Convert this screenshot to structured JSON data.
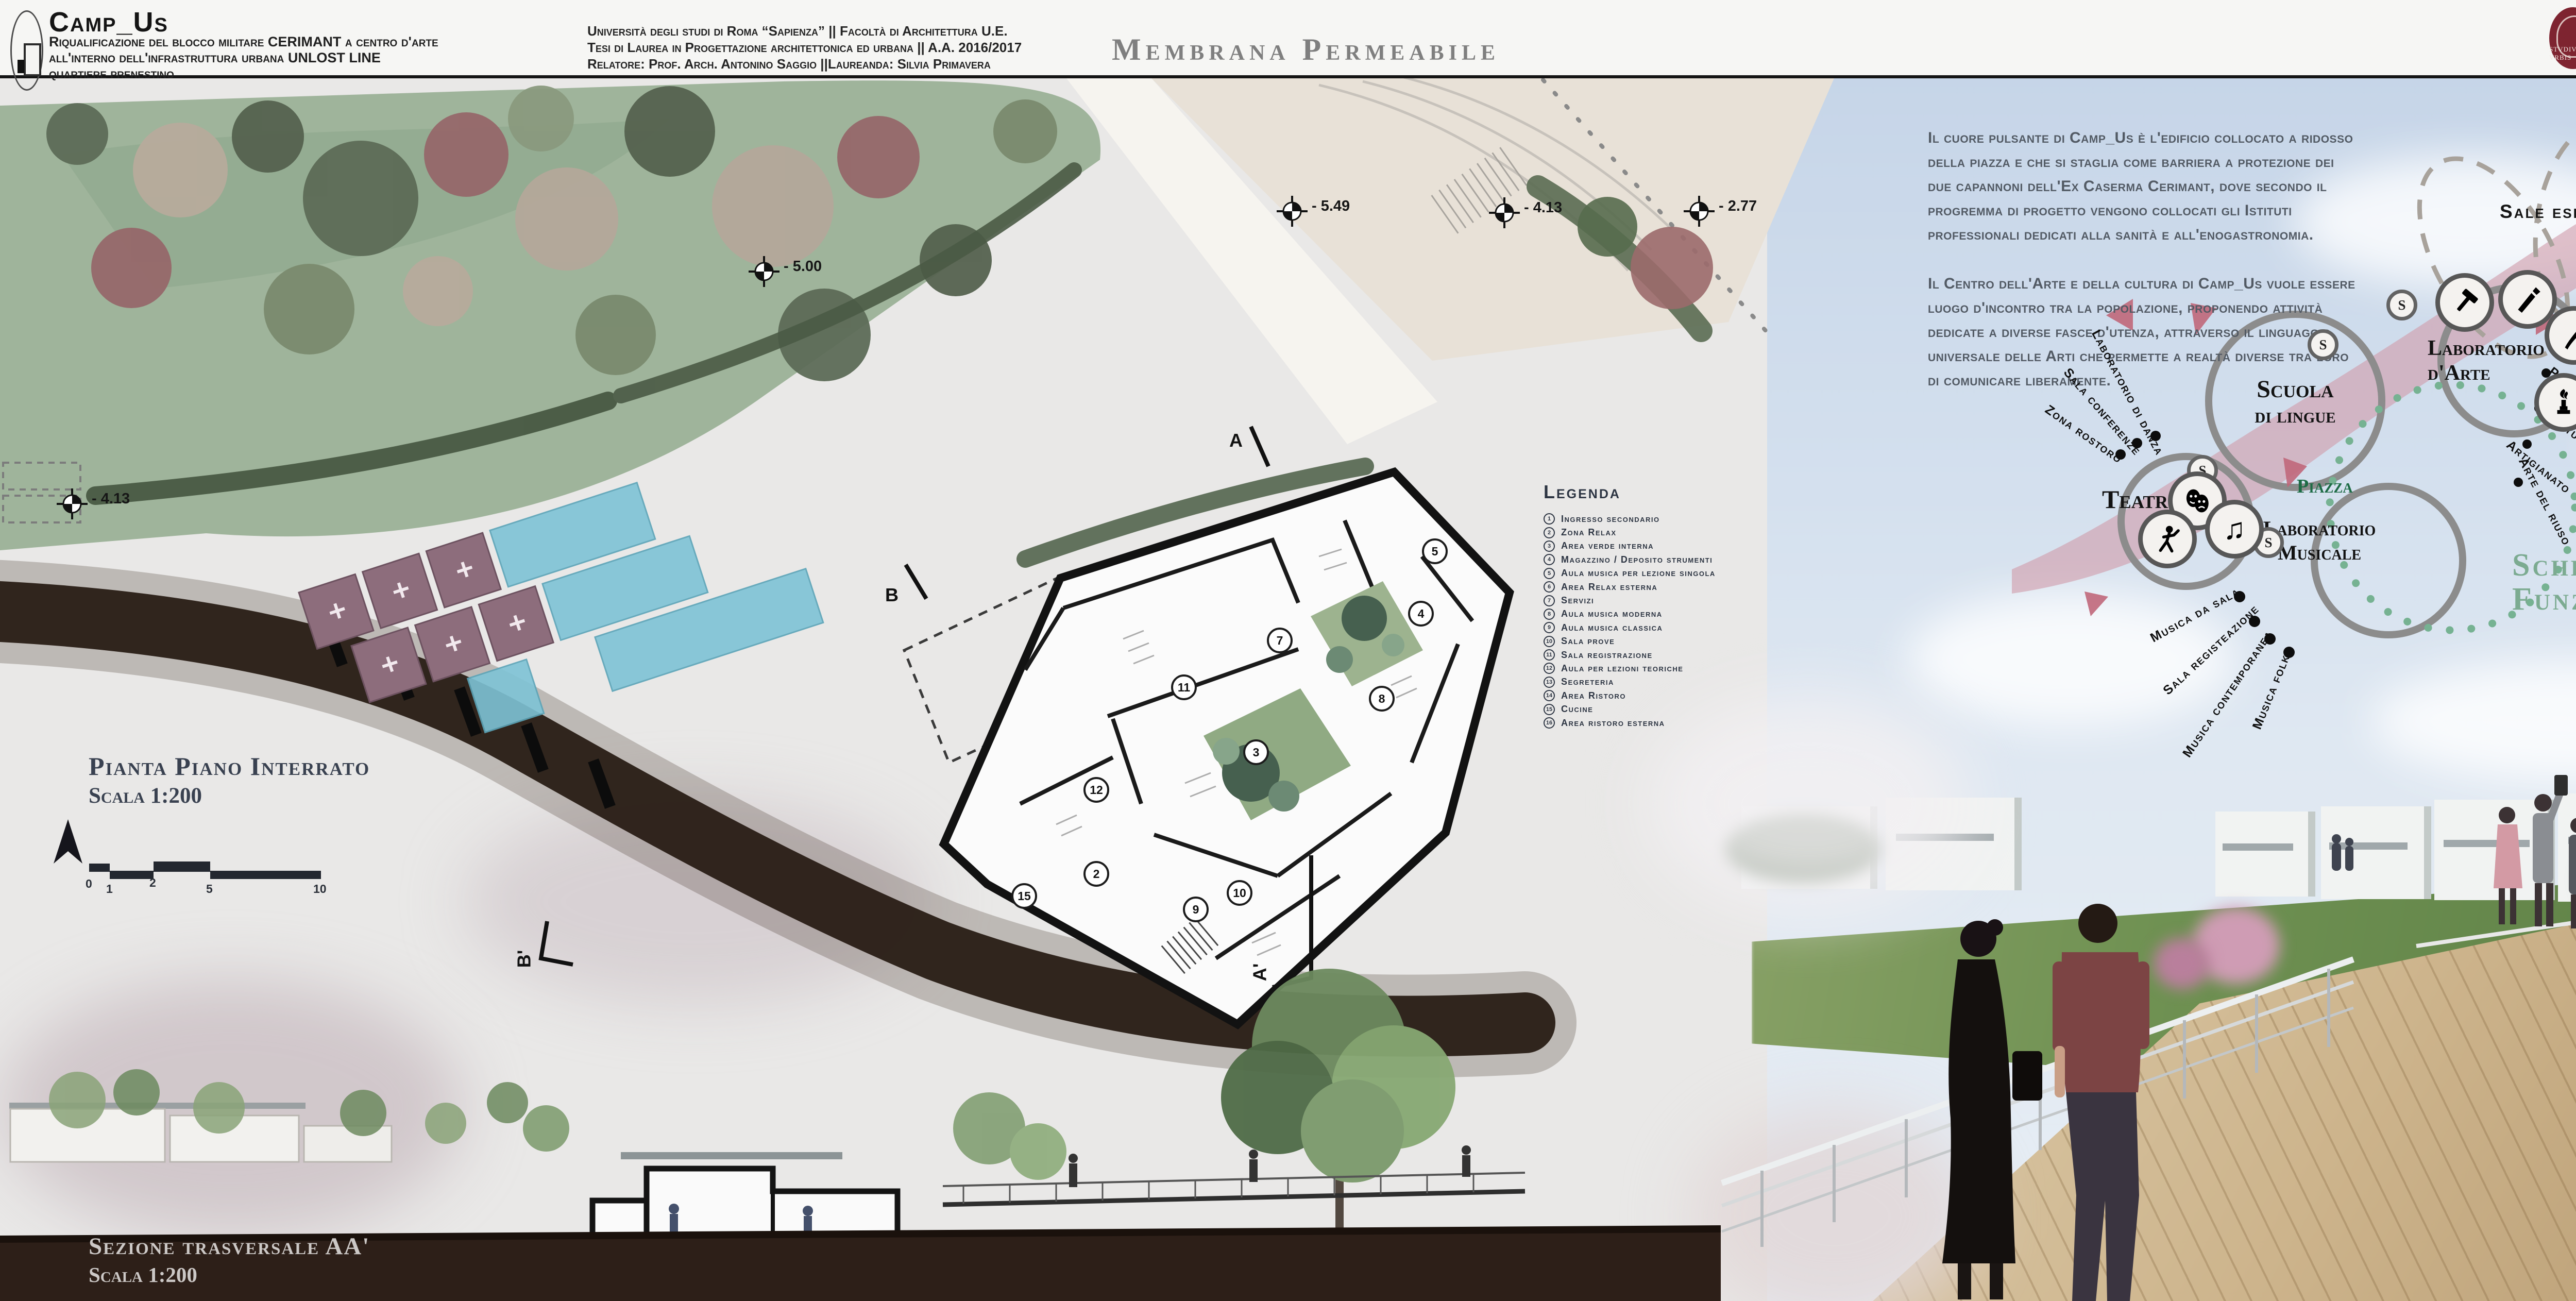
{
  "header": {
    "project": {
      "title": "Camp_Us",
      "subtitle_line1": "Riqualificazione del blocco militare CERIMANT a centro d'arte",
      "subtitle_line2": "all'interno dell'infrastruttura urbana UNLOST LINE",
      "subtitle_line3": "quartiere prenestino"
    },
    "university": {
      "line1": "Università degli studi di Roma “Sapienza” || Facoltà di Architettura U.E.",
      "line2": "Tesi di Laurea in Progettazione architettonica ed urbana ||  A.A. 2016/2017",
      "line3": "Relatore: Prof. Arch. Antonino Saggio ||Laureanda: Silvia Primavera"
    },
    "board_title": "Membrana Permeabile",
    "sapienza": {
      "name": "Sapienza",
      "subtitle": "Università di Roma",
      "emblem_motto": "STVDIVM VRBIS"
    }
  },
  "intro": {
    "para1": "Il cuore pulsante di Camp_Us è l'edificio collocato a ridosso della piazza e che si staglia come barriera a protezione dei due capannoni dell'Ex Caserma Cerimant, dove secondo il progremma di progetto vengono collocati gli Istituti professionali dedicati alla sanità e all'enogastronomia.",
    "para2": "Il Centro dell'Arte e della cultura di Camp_Us vuole essere luogo d'incontro tra la popolazione, proponendo attività dedicate a diverse fasce d'utenza, attraverso il linguaggio universale delle Arti che permette a realtà diverse tra loro di comunicare liberamente."
  },
  "legend": {
    "title": "Legenda",
    "items": [
      {
        "n": "1",
        "label": "Ingresso secondario"
      },
      {
        "n": "2",
        "label": "Zona Relax"
      },
      {
        "n": "3",
        "label": "Area verde interna"
      },
      {
        "n": "4",
        "label": "Magazzino / Deposito strumenti"
      },
      {
        "n": "5",
        "label": "Aula musica per lezione singola"
      },
      {
        "n": "6",
        "label": "Area Relax esterna"
      },
      {
        "n": "7",
        "label": "Servizi"
      },
      {
        "n": "8",
        "label": "Aula musica moderna"
      },
      {
        "n": "9",
        "label": "Aula musica classica"
      },
      {
        "n": "10",
        "label": "Sala prove"
      },
      {
        "n": "11",
        "label": "Sala registrazione"
      },
      {
        "n": "12",
        "label": "Aula per lezioni teoriche"
      },
      {
        "n": "13",
        "label": "Segreteria"
      },
      {
        "n": "14",
        "label": "Area Ristoro"
      },
      {
        "n": "15",
        "label": "Cucine"
      },
      {
        "n": "16",
        "label": "Area ristoro esterna"
      }
    ]
  },
  "scheme": {
    "title_line1": "Schema",
    "title_line2": "Funzionale",
    "sale_espositive": "Sale espositive",
    "piazza": "Piazza",
    "badge": "S",
    "nodes": {
      "scuola_line1": "Scuola",
      "scuola_line2": "di lingue",
      "teatro": "Teatro",
      "arte_line1": "Laboratorio",
      "arte_line2": "d'Arte",
      "musicale_line1": "Laboratorio",
      "musicale_line2": "Musicale"
    },
    "satellites": {
      "danza": "Laboratorio di danza",
      "conferenze": "Sala conferenze",
      "ristoro": "Zona rostoro",
      "musica_sala": "Musica da sala",
      "registrazione": "Sala registeazione",
      "contemporanea": "Musica contemporanea",
      "folk": "Musica folk",
      "uffici": "Uffici dedicati",
      "pittura": "Pittura",
      "scultura": "Scultura",
      "artigianato": "Artigianato",
      "riuso": "Arte del riuso"
    }
  },
  "plan": {
    "title": "Pianta Piano Interrato",
    "scale": "Scala 1:200",
    "scale_ticks": [
      "0",
      "1",
      "2",
      "5",
      "10"
    ],
    "markers": [
      {
        "value": "- 5.49"
      },
      {
        "value": "- 4.13"
      },
      {
        "value": "- 2.77"
      },
      {
        "value": "- 4.13"
      },
      {
        "value": "- 5.00"
      }
    ],
    "rooms": [
      "2",
      "3",
      "4",
      "5",
      "7",
      "8",
      "9",
      "10",
      "11",
      "12",
      "15"
    ],
    "section_marks": {
      "a": "A",
      "a1": "A'",
      "b": "B",
      "b1": "B'"
    }
  },
  "section": {
    "title": "Sezione trasversale AA'",
    "scale": "Scala 1:200"
  },
  "colors": {
    "maroon": "#7e2430",
    "pink_ribbon": "#d09cab",
    "triangle_pink": "#c0677a",
    "sage_title": "#7cab91",
    "piazza_green": "#1d6b45",
    "slate_text": "#394150",
    "scheme_grey": "#8c8c8c",
    "pool_blue": "#7ec3d6",
    "deck_plum": "#8d6d7c"
  }
}
